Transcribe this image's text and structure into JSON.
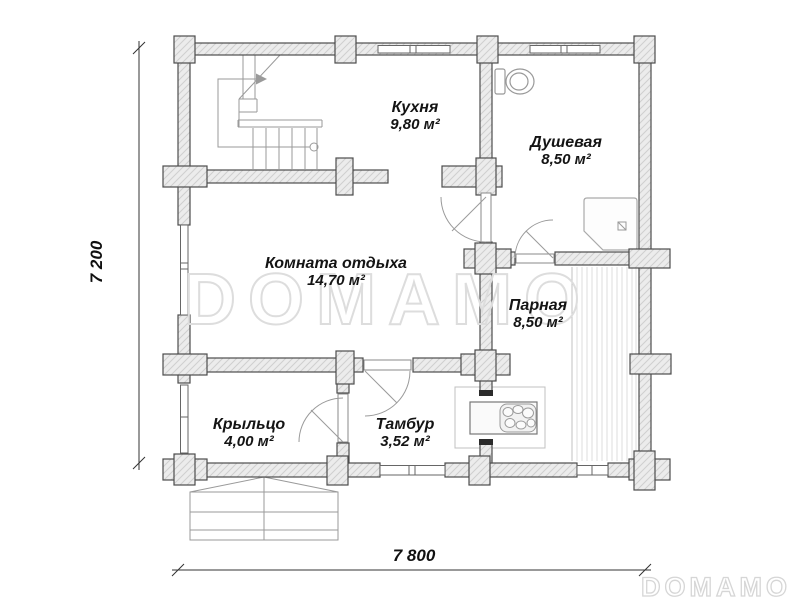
{
  "plan": {
    "rooms": [
      {
        "id": "kitchen",
        "name": "Кухня",
        "area": "9,80 м²"
      },
      {
        "id": "shower",
        "name": "Душевая",
        "area": "8,50 м²"
      },
      {
        "id": "lounge",
        "name": "Комната отдыха",
        "area": "14,70 м²"
      },
      {
        "id": "steam",
        "name": "Парная",
        "area": "8,50 м²"
      },
      {
        "id": "porch",
        "name": "Крыльцо",
        "area": "4,00 м²"
      },
      {
        "id": "tambur",
        "name": "Тамбур",
        "area": "3,52 м²"
      }
    ],
    "dimensions": {
      "height": "7 200",
      "width": "7 800"
    },
    "watermark": {
      "center": "DOMAMO",
      "corner": "DOMAMO"
    },
    "fixtures": [
      "staircase",
      "toilet",
      "shower-tray",
      "sauna-stove",
      "bench-deck",
      "porch-steps"
    ],
    "colors": {
      "wall_fill": "#ececec",
      "wall_hatch": "#cfcfcf",
      "wall_outline": "#4d4d4d",
      "thin_line": "#999999",
      "watermark": "#dddddd",
      "text": "#141414"
    }
  }
}
